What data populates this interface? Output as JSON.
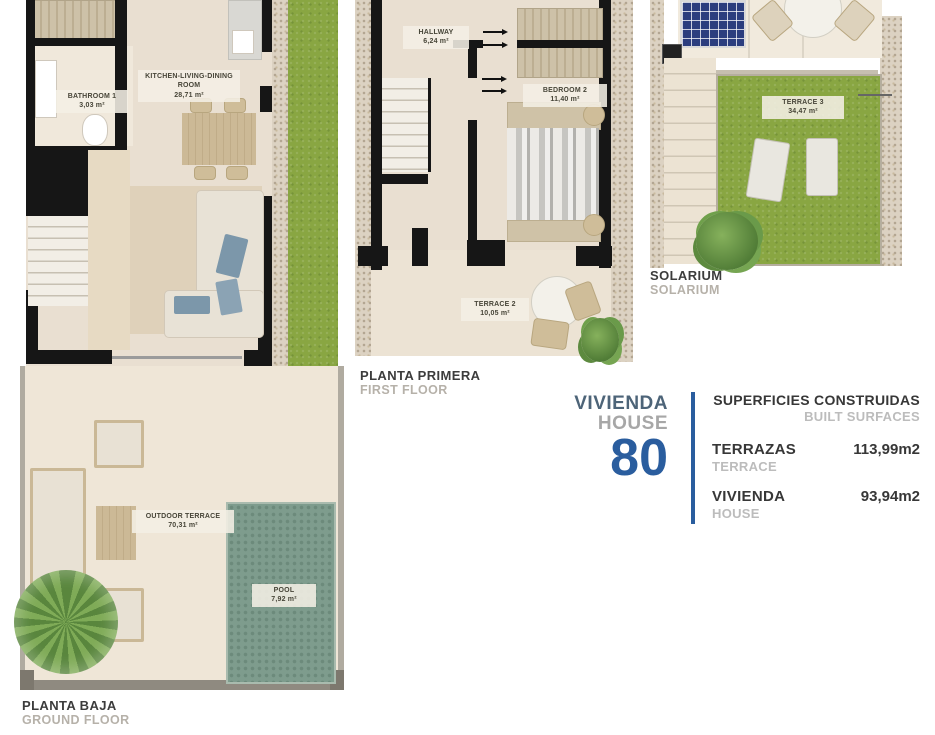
{
  "plans": {
    "ground": {
      "title_es": "PLANTA BAJA",
      "title_en": "GROUND FLOOR",
      "rooms": [
        {
          "name": "BATHROOM 1",
          "area": "3,03 m²"
        },
        {
          "name": "KITCHEN-LIVING-DINING ROOM",
          "area": "28,71 m²"
        },
        {
          "name": "OUTDOOR TERRACE",
          "area": "70,31 m²"
        },
        {
          "name": "POOL",
          "area": "7,92 m²"
        }
      ]
    },
    "first": {
      "title_es": "PLANTA PRIMERA",
      "title_en": "FIRST FLOOR",
      "rooms": [
        {
          "name": "HALLWAY",
          "area": "6,24 m²"
        },
        {
          "name": "BEDROOM 2",
          "area": "11,40 m²"
        },
        {
          "name": "TERRACE 2",
          "area": "10,05 m²"
        }
      ]
    },
    "solarium": {
      "title_es": "SOLARIUM",
      "title_en": "SOLARIUM",
      "rooms": [
        {
          "name": "TERRACE 3",
          "area": "34,47 m²"
        }
      ]
    }
  },
  "info": {
    "house_label_es": "VIVIENDA",
    "house_label_en": "HOUSE",
    "house_number": "80",
    "surfaces_title_es": "SUPERFICIES CONSTRUIDAS",
    "surfaces_title_en": "BUILT SURFACES",
    "rows": [
      {
        "label_es": "TERRAZAS",
        "label_en": "TERRACE",
        "value": "113,99m2"
      },
      {
        "label_es": "VIVIENDA",
        "label_en": "HOUSE",
        "value": "93,94m2"
      }
    ],
    "accent_blue": "#2a5d9e",
    "navy_text": "#4d6478",
    "muted_gray": "#bcbcbc"
  }
}
